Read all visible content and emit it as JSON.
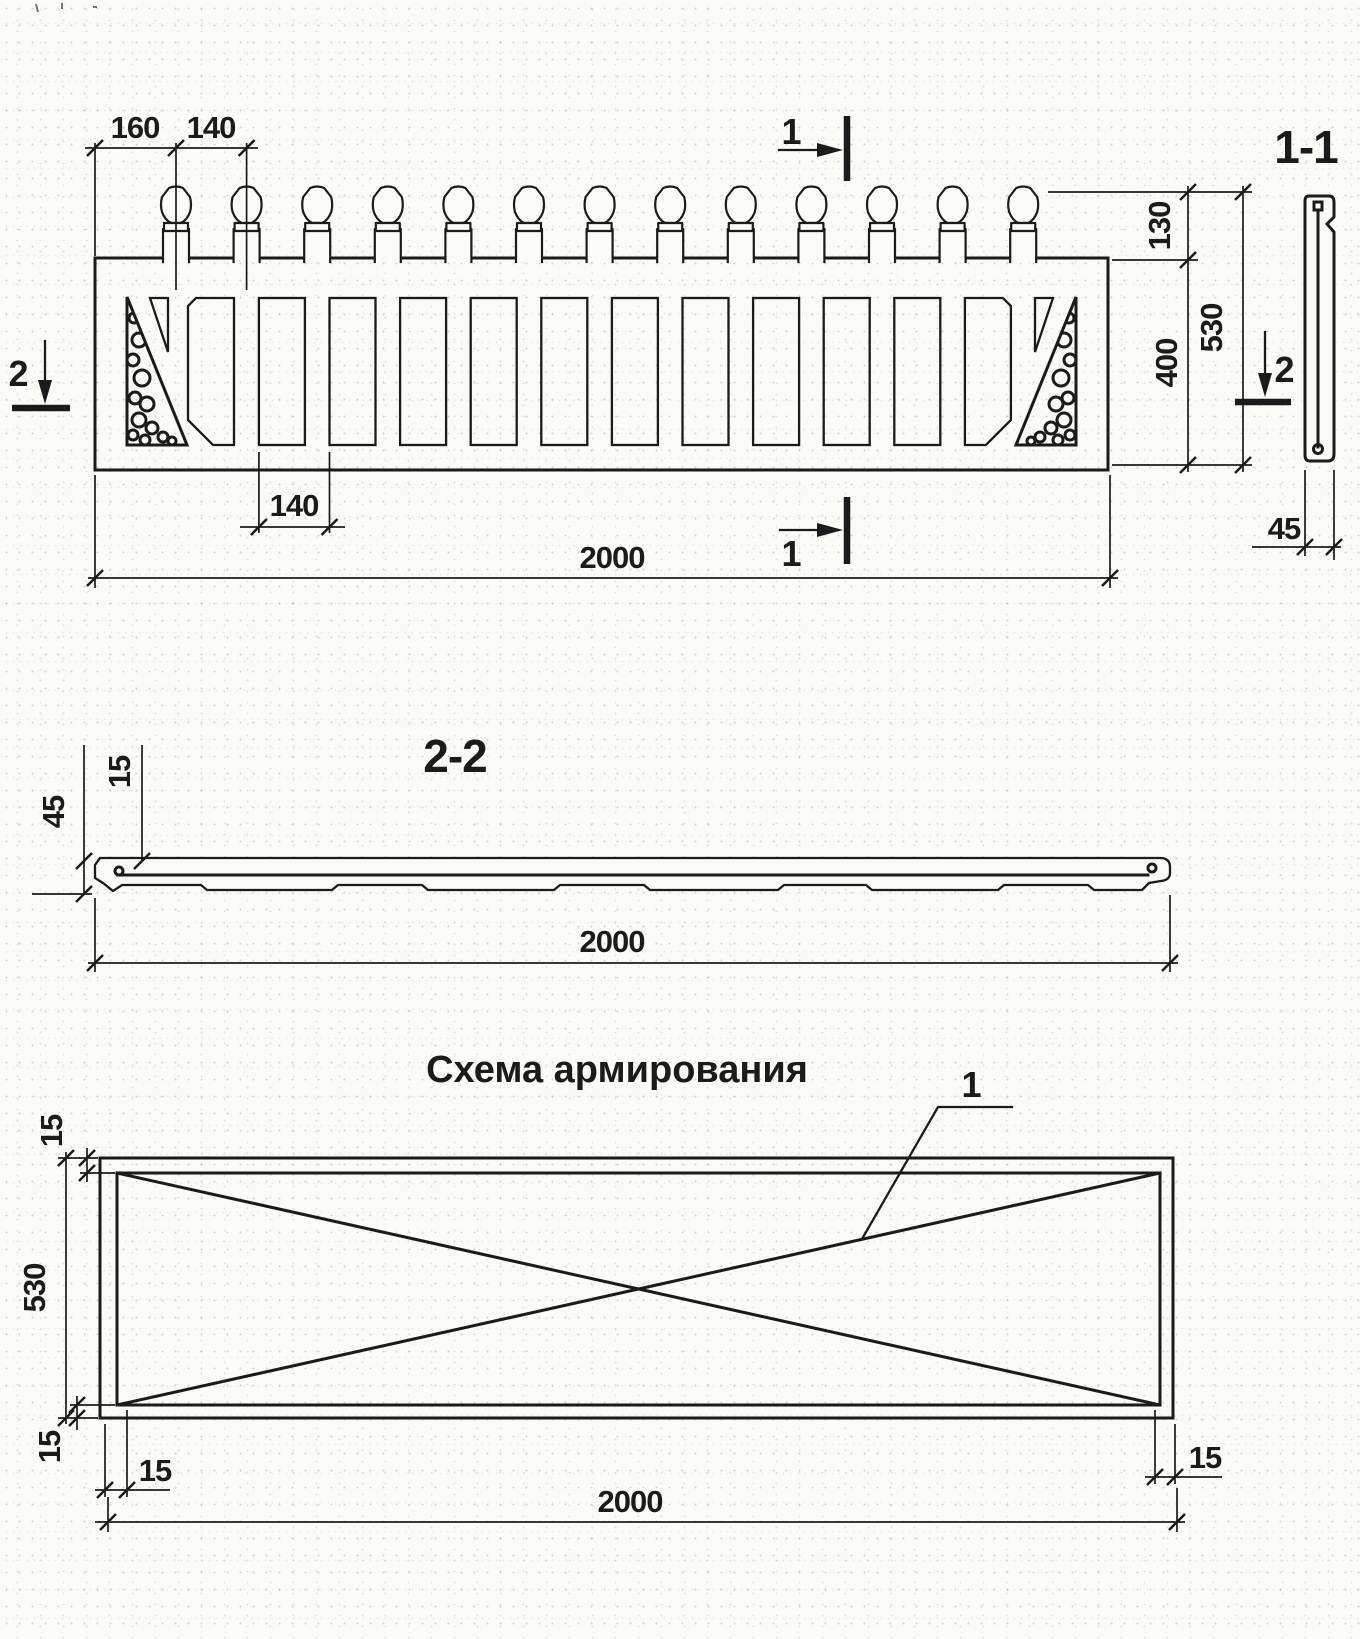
{
  "colors": {
    "ink": "#1b1b1b",
    "paper": "#fafaf7"
  },
  "elevation": {
    "dim_160": "160",
    "dim_140_top": "140",
    "dim_140_bottom": "140",
    "dim_2000": "2000",
    "dim_130": "130",
    "dim_400": "400",
    "dim_530": "530",
    "marker_1_top": "1",
    "marker_1_bottom": "1",
    "marker_2_left": "2",
    "marker_2_right": "2"
  },
  "section_1_1": {
    "title": "1-1",
    "dim_45": "45"
  },
  "section_2_2": {
    "title": "2-2",
    "dim_15": "15",
    "dim_45": "45",
    "dim_2000": "2000"
  },
  "reinforcement": {
    "title": "Схема армирования",
    "callout_1": "1",
    "dim_530": "530",
    "dim_15_top": "15",
    "dim_15_left": "15",
    "dim_15_bottom_left": "15",
    "dim_15_bottom_right": "15",
    "dim_2000": "2000"
  }
}
